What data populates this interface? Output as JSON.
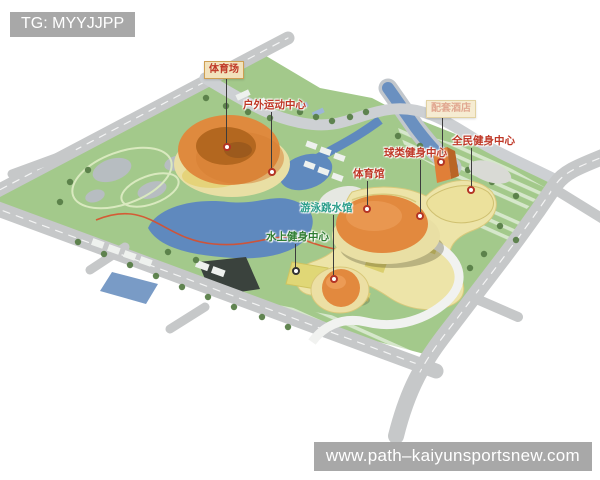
{
  "watermarks": {
    "telegram": "TG: MYYJJPP",
    "website": "www.path–kaiyunsportsnew.com"
  },
  "labels": {
    "stadium": "体育场",
    "outdoor_sports_center": "户外运动中心",
    "faded_facility": "配套酒店",
    "ball_fitness_center": "球类健身中心",
    "public_fitness_center": "全民健身中心",
    "gymnasium": "体育馆",
    "swimming_diving_hall": "游泳跳水馆",
    "water_fitness_center": "水上健身中心"
  },
  "colors": {
    "label_red": "#bf3726",
    "label_teal": "#2a9d8a",
    "label_green": "#2e7d32",
    "badge_bg": "#f2e2bc",
    "badge_border": "#cf9f52",
    "watermark_bg": "#a8a8a8",
    "watermark_text": "#ffffff",
    "building_orange": "#e2893e",
    "podium_cream": "#e9dfa4",
    "complex_yellow": "#ede4a8",
    "park_green": "#a3c98b",
    "water_blue": "#5f89be",
    "road_gray": "#c6c8c9",
    "jogging_path_red": "#d94f2b"
  }
}
